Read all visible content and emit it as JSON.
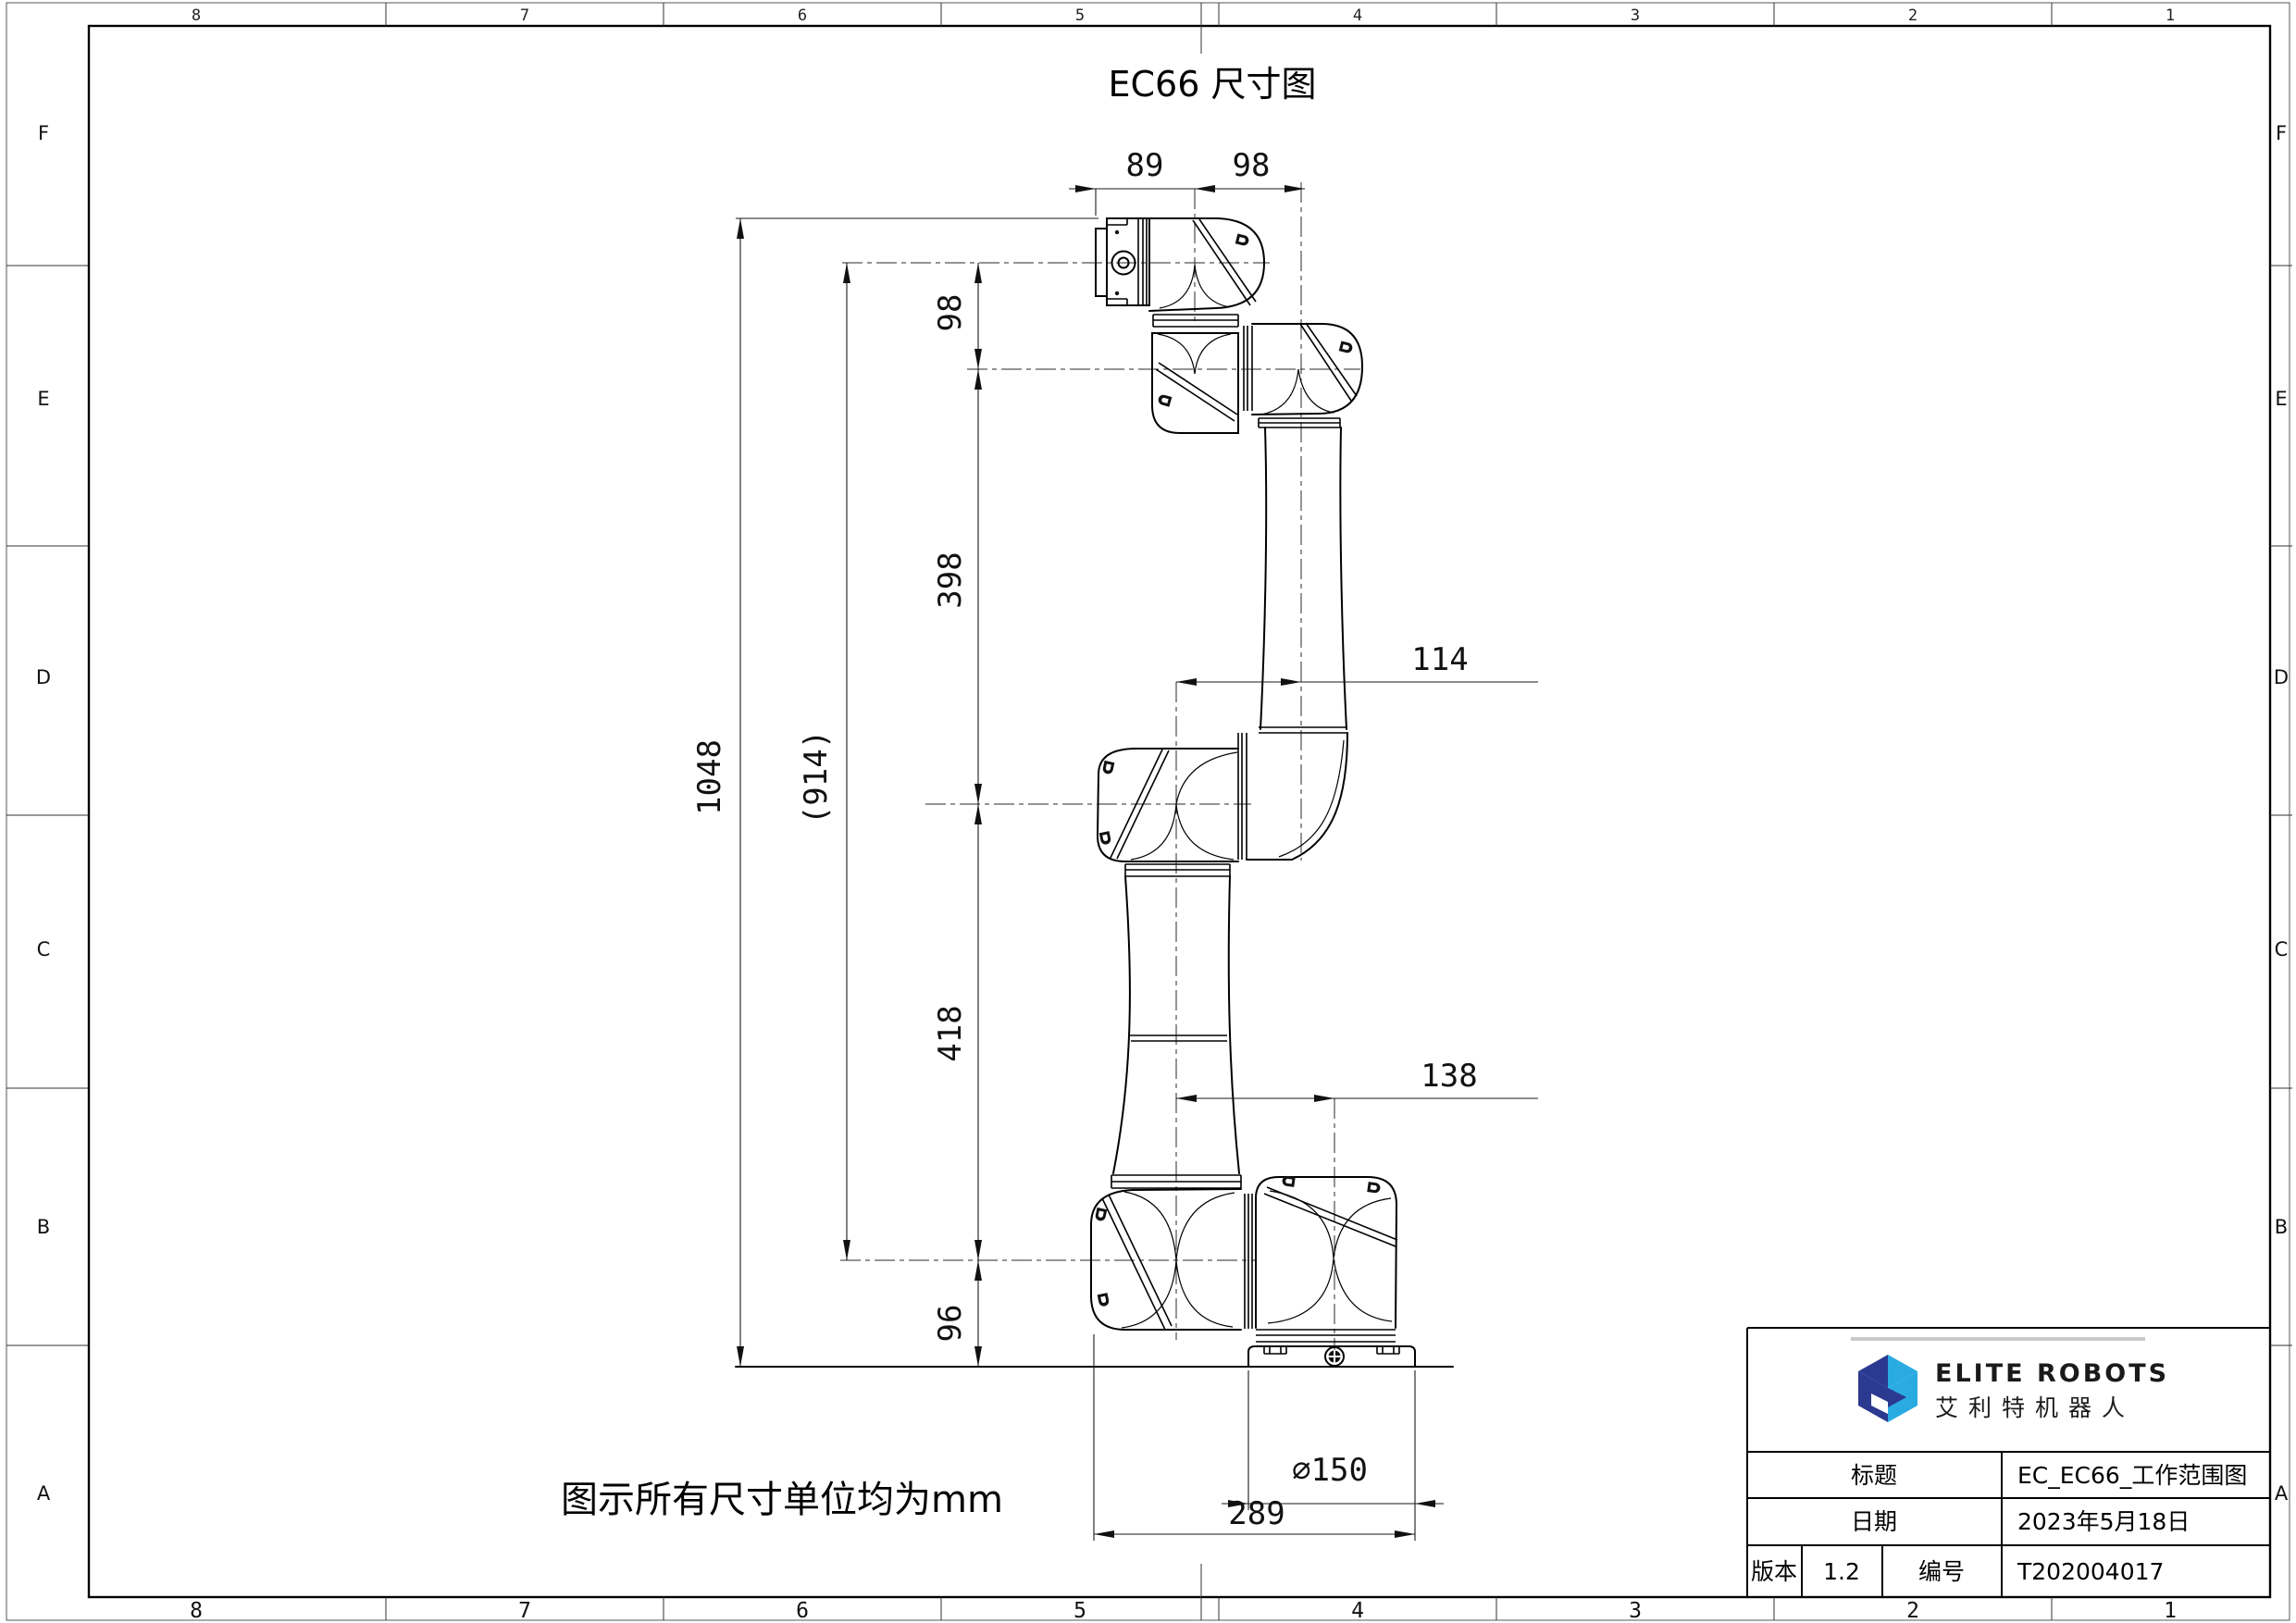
{
  "sheet": {
    "title": "EC66 尺寸图",
    "note": "图示所有尺寸单位均为mm",
    "zones_top": [
      "8",
      "7",
      "6",
      "5",
      "4",
      "3",
      "2",
      "1"
    ],
    "zones_bottom": [
      "8",
      "7",
      "6",
      "5",
      "4",
      "3",
      "2",
      "1"
    ],
    "zones_left": [
      "F",
      "E",
      "D",
      "C",
      "B",
      "A"
    ],
    "zones_right": [
      "F",
      "E",
      "D",
      "C",
      "B",
      "A"
    ]
  },
  "dimensions": {
    "d89": "89",
    "d98_top": "98",
    "d98_left": "98",
    "d398": "398",
    "d418": "418",
    "d96": "96",
    "d1048": "1048",
    "d914": "(914)",
    "d114": "114",
    "d138": "138",
    "d150": "⌀150",
    "d289": "289"
  },
  "title_block": {
    "brand_en": "ELITE ROBOTS",
    "brand_cn": "艾利特机器人",
    "title_label": "标题",
    "title_value": "EC_EC66_工作范围图",
    "date_label": "日期",
    "date_value": "2023年5月18日",
    "version_label": "版本",
    "version_value": "1.2",
    "number_label": "编号",
    "number_value": "T202004017"
  },
  "colors": {
    "logo_navy": "#2b3990",
    "logo_blue": "#29abe2",
    "logo_gray_bar": "#c9c9c9"
  }
}
